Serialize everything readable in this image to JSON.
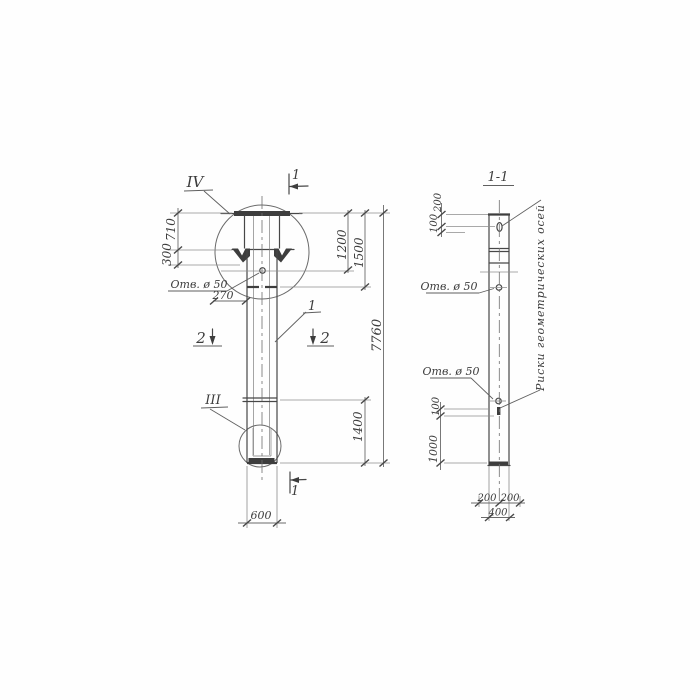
{
  "meta": {
    "paper_color": "#fefefe",
    "ink_color": "#3c3c3c",
    "drawing_type": "reinforced concrete pile / column working drawing"
  },
  "left_view": {
    "detail_mark_top": "IV",
    "section_cut_top": "1",
    "dim_710": "710",
    "dim_300": "300",
    "hole_label": "Отв. ø 50",
    "dim_270": "270",
    "dim_1200": "1200",
    "dim_1500": "1500",
    "dim_7760": "7760",
    "section_mark_left": "2",
    "section_mark_right": "2",
    "part_label": "1",
    "detail_mark_bottom": "III",
    "dim_1400": "1400",
    "dim_600": "600",
    "section_cut_bottom": "1"
  },
  "section_view": {
    "title": "1-1",
    "dim_200_top": "200",
    "dim_100_top": "100",
    "hole_label_upper": "Отв. ø 50",
    "hole_label_lower": "Отв. ø 50",
    "dim_100_mid": "100",
    "dim_1000": "1000",
    "dim_200_bottom_left": "200",
    "dim_200_bottom_right": "200",
    "dim_400": "400",
    "axes_note": "Риски геометрических осей"
  }
}
